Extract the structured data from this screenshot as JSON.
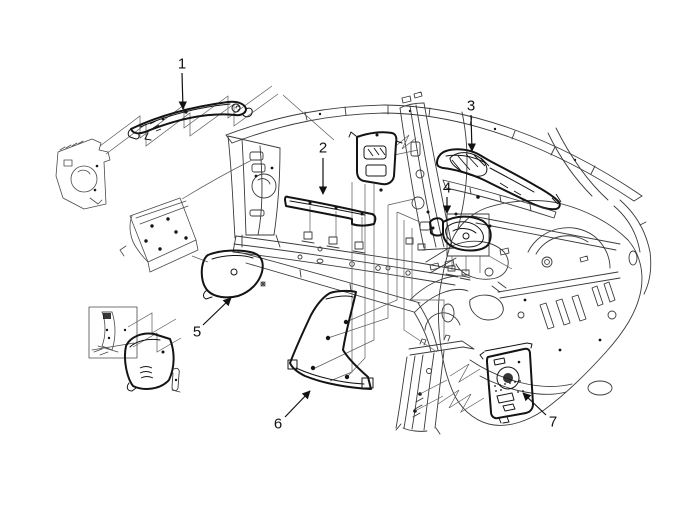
{
  "figure": {
    "kind": "exploded-parts-diagram",
    "background": "#ffffff",
    "line_color": "#3a3a3a",
    "part_line_color": "#141414",
    "inset_line_color": "#4a4a4a",
    "leader_line_color": "#5a5a5a",
    "label_color": "#111111"
  },
  "callouts": [
    {
      "label": "1"
    },
    {
      "label": "2"
    },
    {
      "label": "3"
    },
    {
      "label": "4"
    },
    {
      "label": "5"
    },
    {
      "label": "6"
    },
    {
      "label": "7"
    }
  ]
}
